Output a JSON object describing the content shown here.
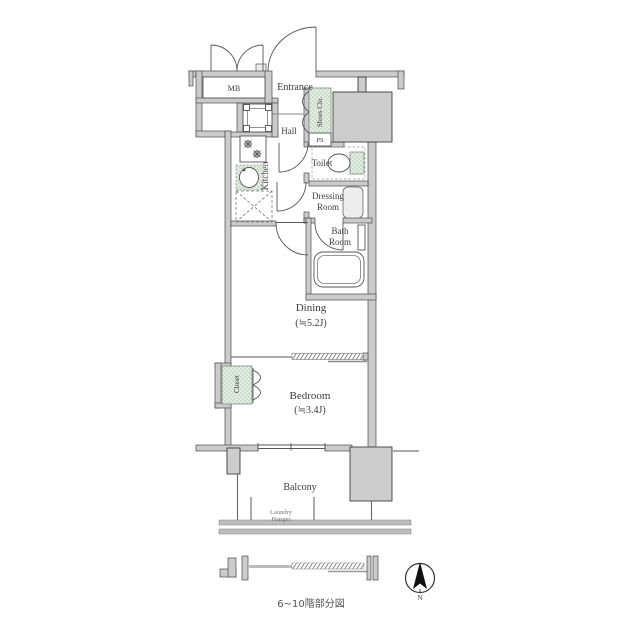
{
  "plan": {
    "labels": {
      "mb": "MB",
      "entrance": "Entrance",
      "shoes_closet": "Shoes Clo.",
      "ps": "PS",
      "hall": "Hall",
      "kitchen": "Kitchen",
      "toilet": "Toilet",
      "dressing_line1": "Dressing",
      "dressing_line2": "Room",
      "bath_line1": "Bath",
      "bath_line2": "Room",
      "dining": "Dining",
      "dining_size": "(≒5.2J)",
      "closet": "Closet",
      "bedroom": "Bedroom",
      "bedroom_size": "(≒3.4J)",
      "balcony": "Balcony",
      "laundry_line1": "Laundry",
      "laundry_line2": "Hanger"
    },
    "compass": {
      "north": "N"
    },
    "caption": "6~10階部分図",
    "colors": {
      "wall_fill": "#cbcbcb",
      "wall_stroke": "#4a4a4a",
      "column_fill": "#cdcdcd",
      "closet_green": "#e3ece3",
      "closet_green_stroke": "#7d917d",
      "label_text": "#3d3d3d",
      "muted_text": "#777777"
    }
  }
}
